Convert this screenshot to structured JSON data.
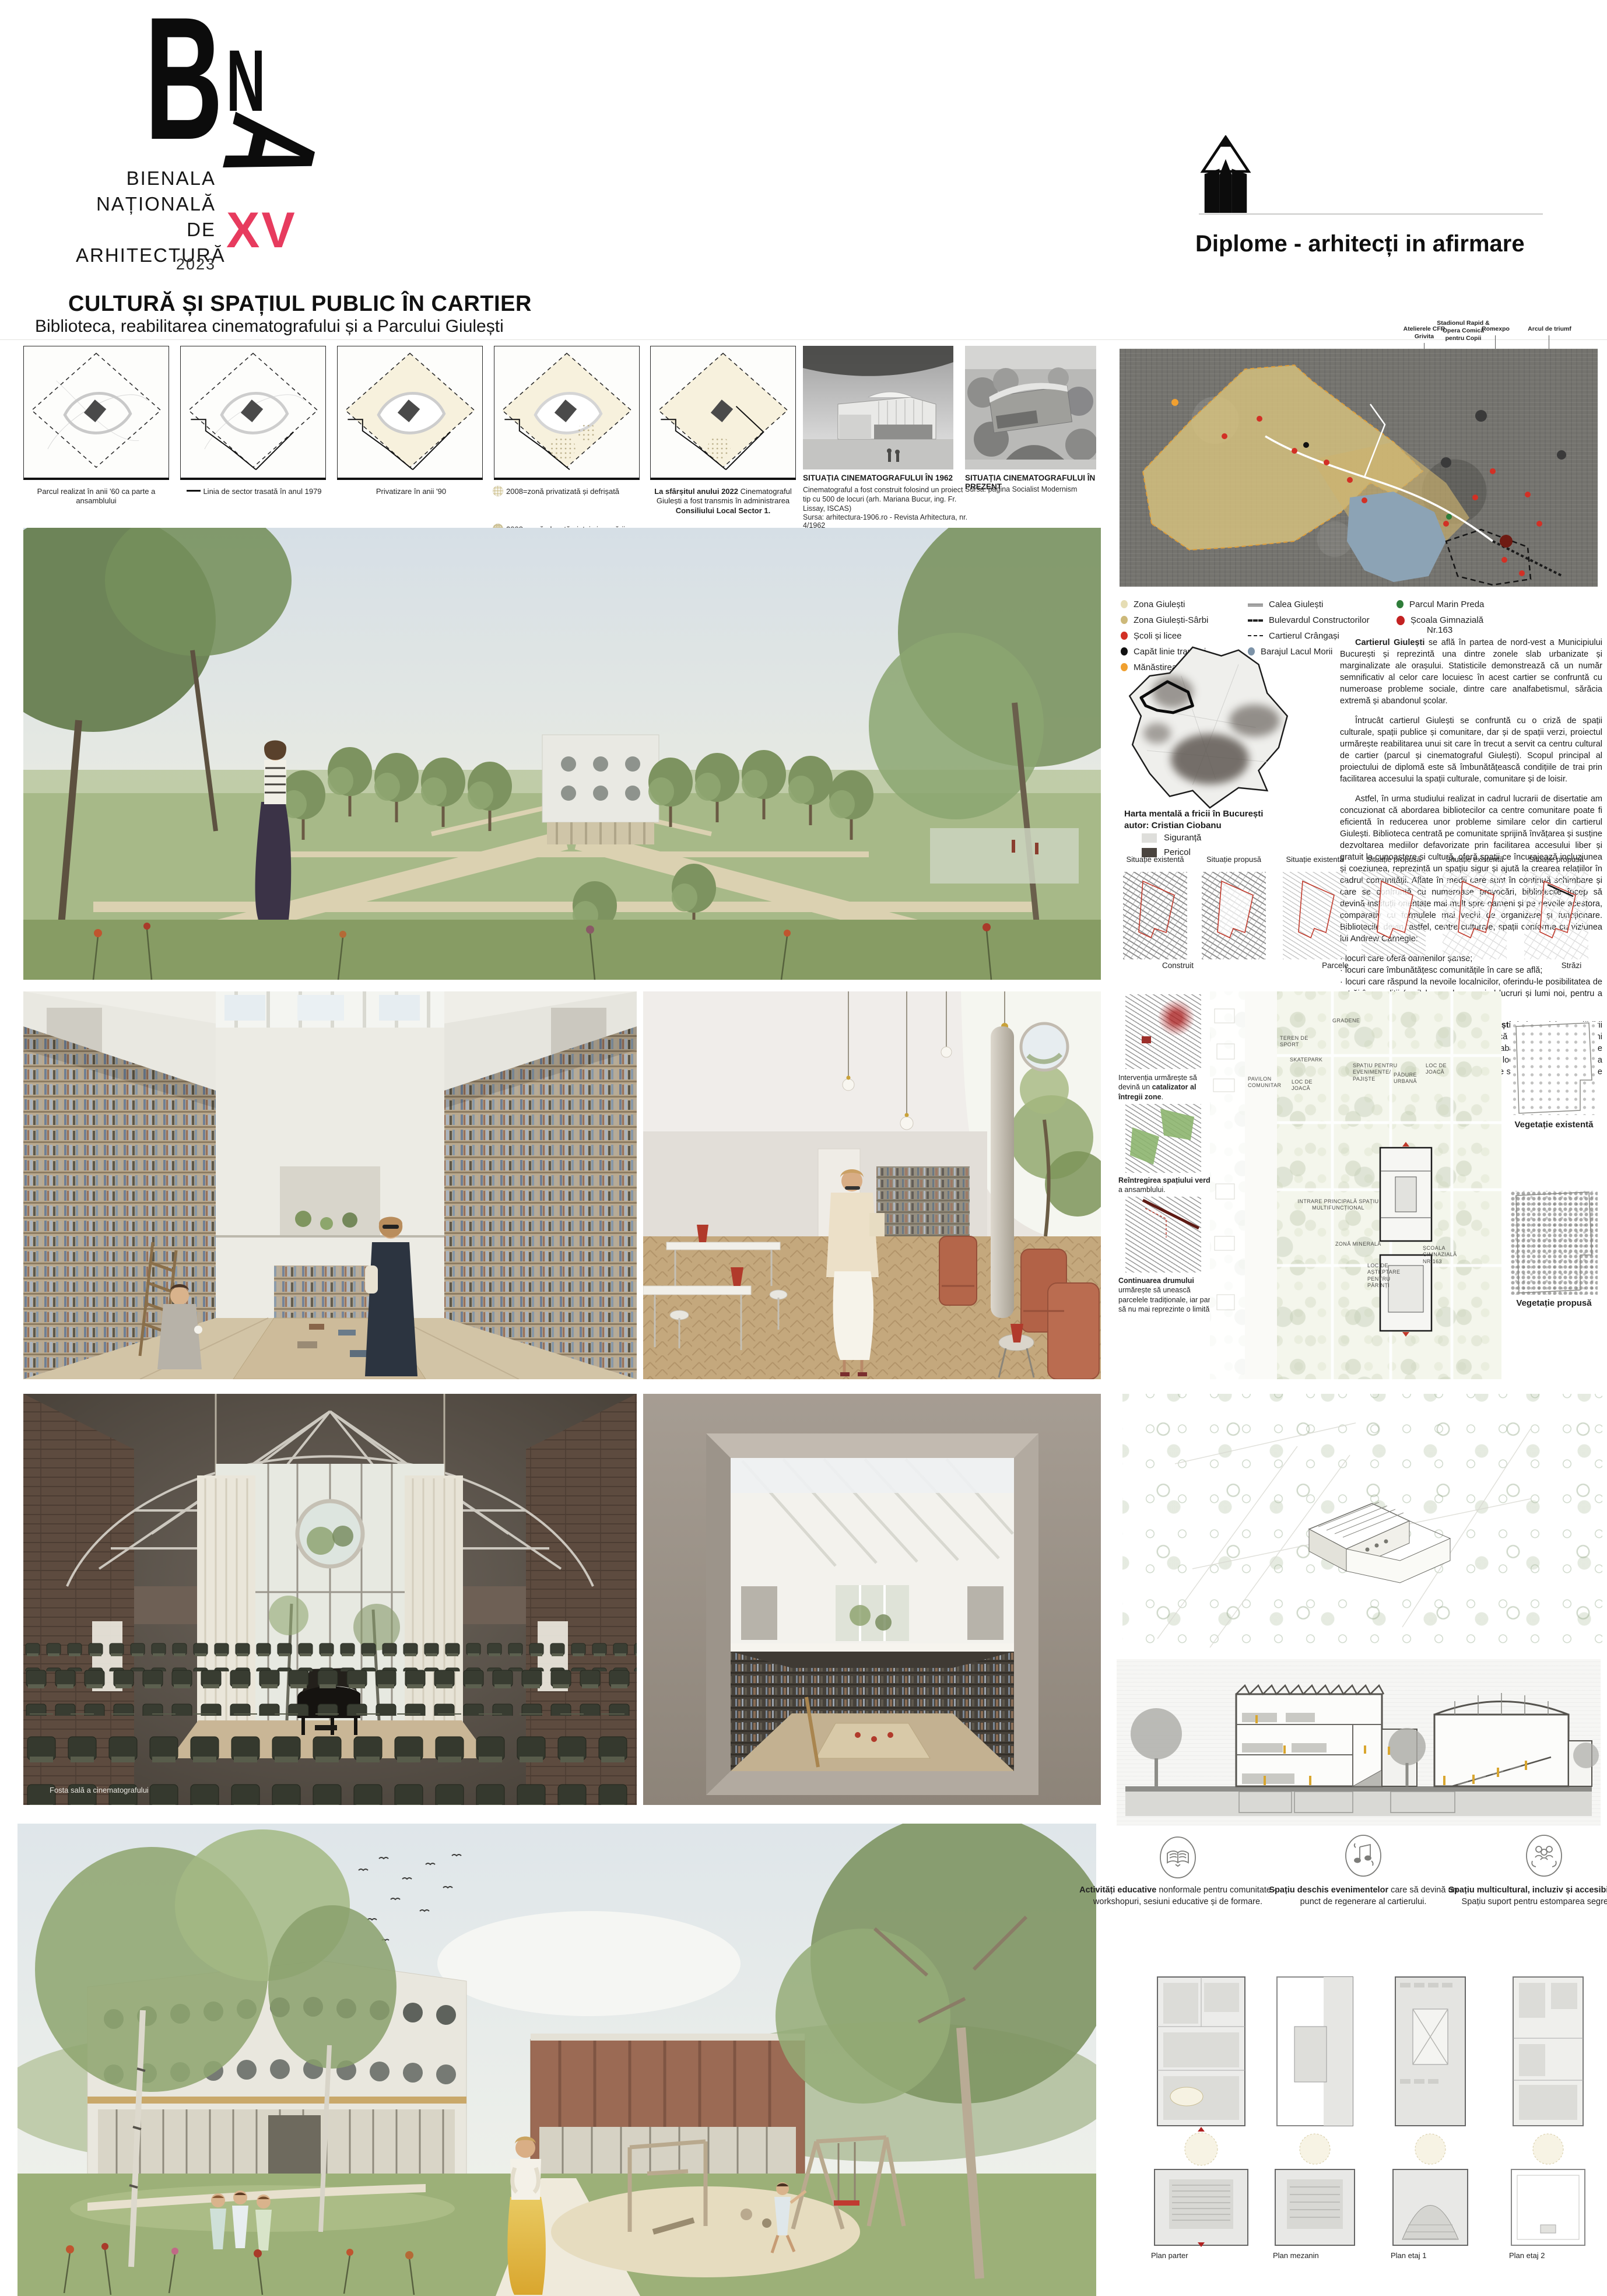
{
  "board": {
    "logo": {
      "b": "B",
      "n": "N",
      "a": "A",
      "lines": [
        "BIENALA",
        "NAȚIONALĂ",
        "DE",
        "ARHITECTURĂ"
      ],
      "edition": "XV",
      "year": "2023"
    },
    "title": "CULTURĂ ȘI SPAȚIUL PUBLIC ÎN CARTIER",
    "subtitle": "Biblioteca, reabilitarea cinematografului și a Parcului Giulești",
    "award": "Diplome - arhitecți in afirmare"
  },
  "history": {
    "diagrams": [
      {
        "caption": "Parcul realizat în anii '60 ca parte a ansamblului"
      },
      {
        "caption": "Linia de sector trasată în anul 1979"
      },
      {
        "caption": "Privatizare în anii '90"
      },
      {
        "caption": "2008=zonă privatizată și defrișată",
        "caption2": "2008=zonă alocată pieței și parcării"
      },
      {
        "lead": "La sfârșitul anului 2022",
        "mid": " Cinematograful Giulești a fost transmis în administrarea ",
        "tail": "Consiliului Local Sector 1."
      }
    ],
    "photos": [
      {
        "title": "SITUAȚIA CINEMATOGRAFULUI ÎN 1962",
        "caption": "Cinematograful a fost construit folosind un proiect tip cu 500 de locuri (arh. Mariana Bucur, ing. Fr. Lissay, ISCAS)",
        "source": "Sursa: arhitectura-1906.ro - Revista Arhitectura, nr. 4/1962"
      },
      {
        "title": "SITUAȚIA CINEMATOGRAFULUI ÎN PREZENT",
        "source": "Sursa: pagina Socialist Modernism"
      }
    ]
  },
  "map": {
    "callouts": [
      "Atelierele CFR Grivita",
      "Stadionul Rapid & Opera Comică pentru Copii",
      "Romexpo",
      "Arcul de triumf"
    ],
    "legend": {
      "col1": [
        {
          "label": "Zona Giulești",
          "color": "#e6ddb4"
        },
        {
          "label": "Zona Giulești-Sârbi",
          "color": "#cdb97a"
        },
        {
          "label": "Școli și licee",
          "color": "#d23025"
        },
        {
          "label": "Capăt linie tramvai",
          "color": "#111111"
        },
        {
          "label": "Mănăstirea Chiajna",
          "color": "#f0a030"
        }
      ],
      "col2": [
        {
          "label": "Calea Giulești",
          "swatch": "double-line"
        },
        {
          "label": "Bulevardul Constructorilor",
          "swatch": "thick-dash"
        },
        {
          "label": "Cartierul Crângași",
          "swatch": "dash"
        },
        {
          "label": "Barajul Lacul Morii",
          "color": "#7d93a8"
        }
      ],
      "col3": [
        {
          "label": "Parcul Marin Preda",
          "color": "#2f7d3a"
        },
        {
          "label": "Școala Gimnazială",
          "label2": "Nr.163",
          "color": "#c32222"
        }
      ]
    }
  },
  "mental_map": {
    "caption": "Harta mentală a fricii în București",
    "author": "autor: Cristian Ciobanu",
    "legend": [
      {
        "label": "Siguranță"
      },
      {
        "label": "Pericol"
      }
    ]
  },
  "essay": {
    "p1_lead": "Cartierul Giulești",
    "p1_rest": " se află în partea de nord-vest a Municipiului București și reprezintă una dintre zonele slab urbanizate și marginalizate ale orașului. Statisticile demonstrează că un număr semnificativ al celor care locuiesc în acest cartier se confruntă cu numeroase probleme sociale, dintre care analfabetismul, sărăcia extremă și abandonul școlar.",
    "p2": "Întrucât cartierul Giulești se confruntă cu o criză de spații culturale, spații publice și comunitare, dar și de spații verzi, proiectul urmărește reabilitarea unui sit care în trecut a servit ca centru cultural de cartier (parcul și cinematograful Giulești). Scopul principal al proiectului de diplomă este să îmbunătățească condițiile de trai prin facilitarea accesului la spații culturale, comunitare și de loisir.",
    "p3": "Astfel, în urma studiului realizat in cadrul lucrarii de disertatie am concuzionat că abordarea bibliotecilor ca centre comunitare poate fi eficientă în reducerea unor probleme similare celor din cartierul Giulești. Biblioteca centrată pe comunitate sprijină învățarea și susține dezvoltarea mediilor defavorizate prin facilitarea accesului liber și gratuit la cunoaștere și cultură, oferă spații ce încurajează incluziunea și coeziunea, reprezintă un spațiu sigur și ajută la crearea relațiilor în cadrul comunității. Aflate în medii care sunt în continuă schimbare și care se confruntă cu numeroase provocări, bibliotecile încep să devină instituții orientate mai mult spre oameni și pe nevoile acestora, comparativ cu formulele mai vechi de organizare și funcționare. Bibliotecile devin, astfel, centre culturale, spații conforme cu viziunea lui Andrew Carnegie:",
    "bullets": [
      "· locuri care oferă oamenilor șanse;",
      "· locuri care îmbunătățesc comunitățile în care se află;",
      "· locuri care răspund la nevoile localnicilor, oferindu-le posibilitatea de a trăi în condiții (mai) bune, descoperind lucruri și lumi noi, pentru a putea aspira la mai mult."
    ],
    "p4_lead": "Reabilitarea cinematografului Giulești",
    "p4_rest": " (prin reciclarea clădirii abandonate), extinderea lui cu o bibliotecă și diverse alte funcțiuni publice vor transforma actualul spațiu abandonat, considerat de comunitate ca fiind periculos, într-un loc în care dezvoltarea educațională și culturală a locuitorilor poate să înceapă de la premise mai bune."
  },
  "situatie": {
    "headers": [
      "Situație existentă",
      "Situație propusă",
      "Situație existentă",
      "Situație propusă",
      "Situație existentă",
      "Situație propusă"
    ],
    "labels": [
      "Construit",
      "Parcele",
      "Străzi"
    ]
  },
  "concepts": [
    {
      "pre": "Intervenția urmărește să devină un ",
      "lead": "catalizator al întregii zone",
      "post": "."
    },
    {
      "pre": "",
      "lead": "Reîntregirea spațiului verde",
      "post": " a ansamblului."
    },
    {
      "pre": "",
      "lead": "Continuarea drumului",
      "post": " urmărește să unească parcelele tradiționale, iar parcul să nu mai reprezinte o limită."
    }
  ],
  "masterplan": {
    "labels": [
      "GRADENE",
      "TEREN DE SPORT",
      "SKATEPARK",
      "PAVILON COMUNITAR",
      "LOC DE JOACĂ",
      "SPAȚIU PENTRU EVENIMENTE/ PAJIȘTE",
      "PĂDURE URBANĂ",
      "LOC DE JOACĂ",
      "INTRARE PRINCIPALĂ SPAȚIU MULTIFUNCȚIONAL",
      "ZONĂ MINERALĂ",
      "ȘCOALA GIMNAZIALĂ NR.163",
      "LOC DE AȘTEPTARE PENTRU PĂRINȚI"
    ]
  },
  "vegetation": {
    "existing": "Vegetație existentă",
    "proposed": "Vegetație propusă"
  },
  "features": [
    {
      "icon": "open-book",
      "lead": "Activități educative",
      "rest": " nonformale pentru comunitate - workshopuri, sesiuni educative și de formare."
    },
    {
      "icon": "music-notes",
      "lead": "Spațiu deschis evenimentelor",
      "rest": " care să devină un punct de regenerare al cartierului."
    },
    {
      "icon": "people-hands",
      "lead": "Spațiu multicultural, incluziv și accesibil",
      "rest": " tuturor. Spațiu suport pentru estomparea segregării."
    }
  ],
  "plans": {
    "labels": [
      "Plan parter",
      "Plan mezanin",
      "Plan etaj 1",
      "Plan etaj 2"
    ]
  },
  "renders": {
    "cinema_caption": "Fosta sală a cinematografului"
  },
  "colors": {
    "accent_pink": "#e73b5e",
    "map_zone_tan": "#d9c47e",
    "map_zone_border": "#df9e3a",
    "lake": "#8ca3b5",
    "legend_red": "#d23025",
    "legend_orange": "#f0a030",
    "legend_green": "#2f7d3a",
    "legend_blue_gray": "#7d93a8",
    "section_figure_yellow": "#d9a62e",
    "terracotta": "#b4664a"
  }
}
